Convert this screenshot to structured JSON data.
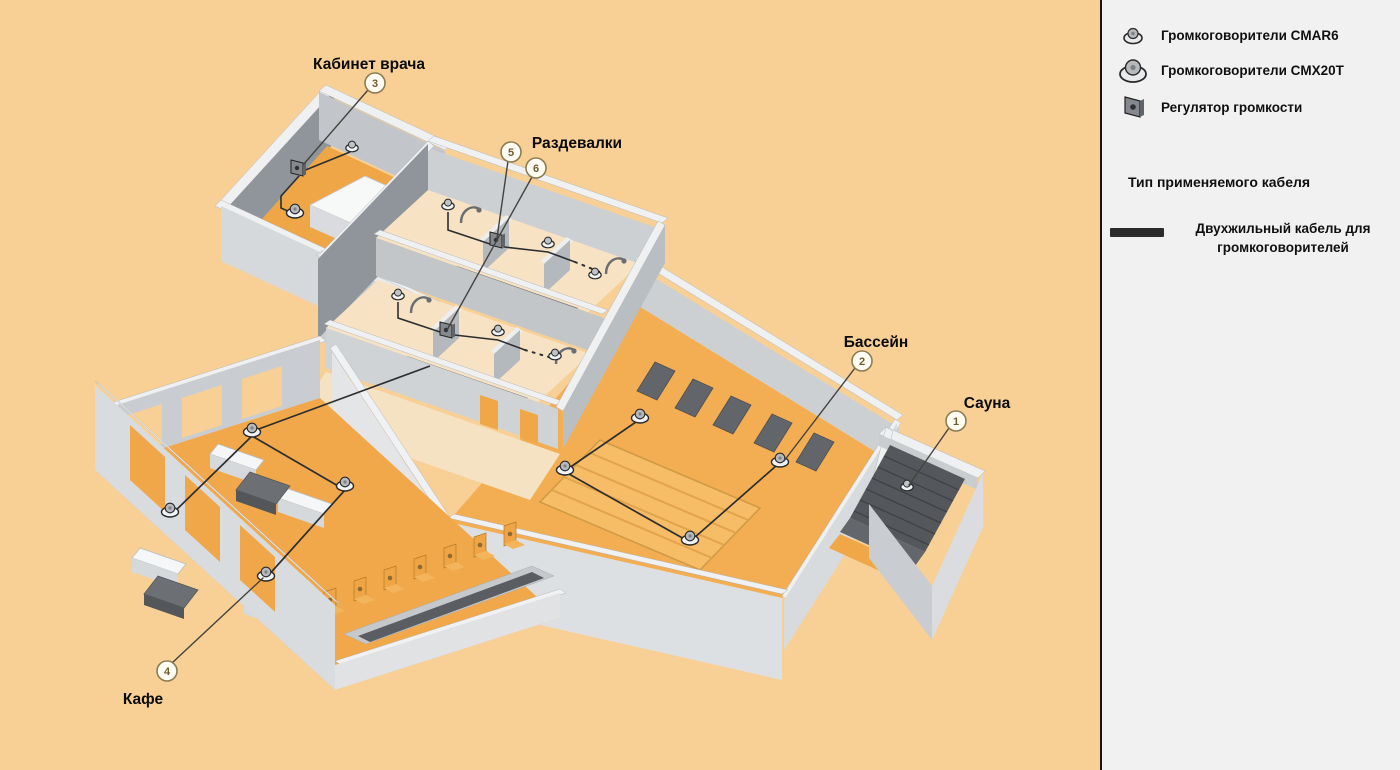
{
  "diagram": {
    "rooms": [
      {
        "id": "doctor-office",
        "label": "Кабинет врача"
      },
      {
        "id": "locker-rooms",
        "label": "Раздевалки"
      },
      {
        "id": "pool",
        "label": "Бассейн"
      },
      {
        "id": "sauna",
        "label": "Сауна"
      },
      {
        "id": "cafe",
        "label": "Кафе"
      }
    ],
    "callouts": [
      {
        "num": "1",
        "target": "Сауна"
      },
      {
        "num": "2",
        "target": "Бассейн"
      },
      {
        "num": "3",
        "target": "Кабинет врача"
      },
      {
        "num": "4",
        "target": "Кафе"
      },
      {
        "num": "5",
        "target": "Раздевалки"
      },
      {
        "num": "6",
        "target": "Раздевалки"
      }
    ]
  },
  "legend": {
    "items": [
      {
        "icon": "ceiling-speaker-small-icon",
        "label": "Громкоговорители CMAR6"
      },
      {
        "icon": "ceiling-speaker-large-icon",
        "label": "Громкоговорители CMX20T"
      },
      {
        "icon": "volume-regulator-icon",
        "label": "Регулятор громкости"
      }
    ],
    "cable_section_title": "Тип применяемого кабеля",
    "cable_item": {
      "icon": "cable-swatch",
      "label_line1": "Двухжильный кабель для",
      "label_line2": "громкоговорителей"
    }
  },
  "colors": {
    "background": "#f8d096",
    "panel": "#f1f1f2",
    "floor_orange": "#f0a747",
    "floor_cream": "#f6e3c3",
    "pool_water": "#f6bc66",
    "wall_light": "#d9dcde",
    "wall_dark": "#8f959b",
    "furniture_dark": "#62666b",
    "cable": "#2c2e30",
    "callout_ring": "#8d7c52"
  }
}
